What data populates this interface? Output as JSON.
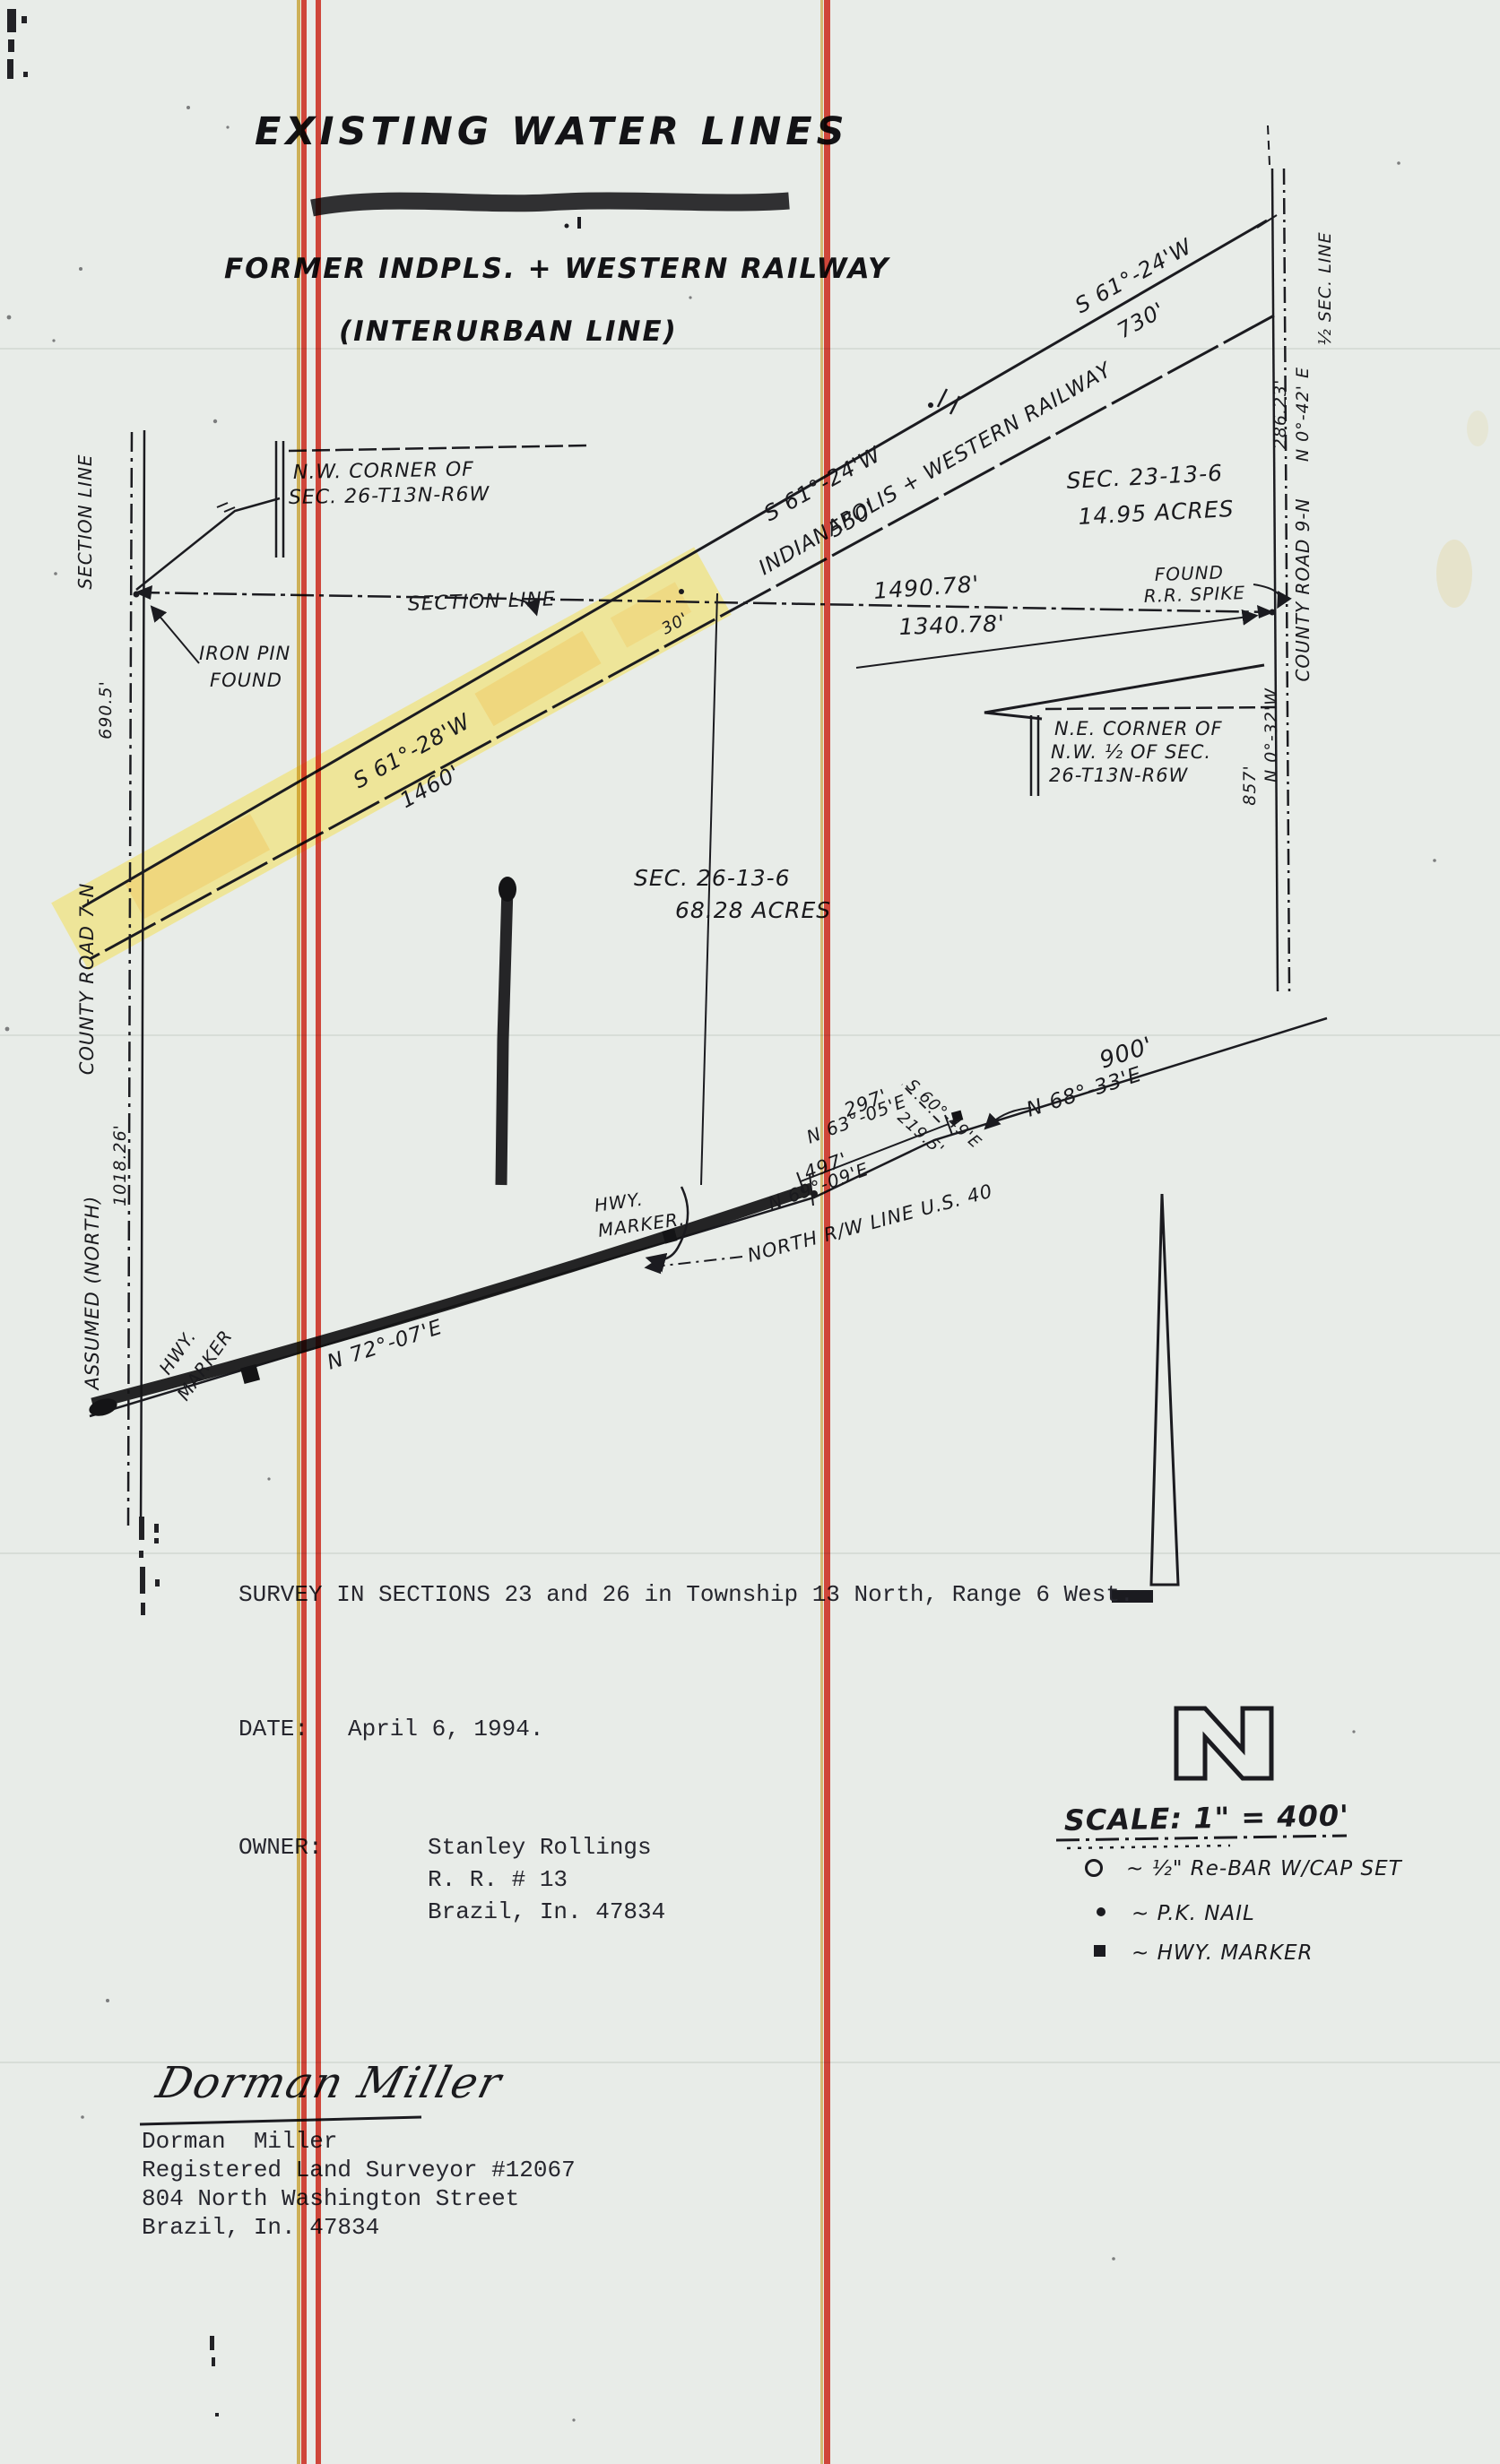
{
  "document": {
    "title": "EXISTING WATER LINES",
    "subtitle_line1": "FORMER INDPLS. + WESTERN RAILWAY",
    "subtitle_line2": "(INTERURBAN LINE)"
  },
  "map": {
    "nw_corner": {
      "l1": "N.W. CORNER OF",
      "l2": "SEC. 26-T13N-R6W"
    },
    "iron_pin": {
      "l1": "IRON PIN",
      "l2": "FOUND"
    },
    "section_line_label": "SECTION LINE",
    "dim_1490": "1490.78'",
    "dim_1340": "1340.78'",
    "dim_30": "30'",
    "found_spike": {
      "l1": "FOUND",
      "l2": "R.R. SPIKE"
    },
    "ne_corner": {
      "l1": "N.E. CORNER OF",
      "l2": "N.W. ½ OF SEC.",
      "l3": "26-T13N-R6W"
    },
    "bearing_730": {
      "bearing": "S 61°-24'W",
      "dist": "730'"
    },
    "bearing_550": {
      "bearing": "S 61°-24'W",
      "dist": "550'"
    },
    "bearing_1460": {
      "bearing": "S 61°-28'W",
      "dist": "1460'"
    },
    "railway_name": "INDIANAPOLIS + WESTERN RAILWAY",
    "sec23": {
      "l1": "SEC. 23-13-6",
      "l2": "14.95 ACRES"
    },
    "sec26": {
      "l1": "SEC. 26-13-6",
      "l2": "68.28 ACRES"
    },
    "right_road": {
      "half_sec": "½ SEC. LINE",
      "bearing": "N 0°-42' E",
      "dim": "286.23'",
      "name": "COUNTY ROAD 9-N",
      "bearing2": "N 0°-32'W",
      "dim2": "857'"
    },
    "left_road": {
      "section": "SECTION LINE",
      "dim": "690.5'",
      "name": "COUNTY ROAD 7-N",
      "dim2": "1018.26'",
      "assumed": "ASSUMED (NORTH)"
    },
    "us40": {
      "bearing_7207": "N 72°-07'E",
      "hwy_marker_a": {
        "l1": "HWY.",
        "l2": "MARKER"
      },
      "hwy_marker_b": {
        "l1": "HWY.",
        "l2": "MARKER."
      },
      "dim_297": "297'",
      "bearing_6305": "N 63°-05'E",
      "bearing_6049": "S 60°-49'E",
      "dim_2195": "219.5'",
      "dim_497": "497'",
      "bearing_6909": "N 69°-09'E",
      "bearing_6833": "N 68°-33'E",
      "dim_900": "900'",
      "rw_label": "NORTH R/W LINE U.S. 40"
    }
  },
  "notes": {
    "survey_line": "SURVEY IN SECTIONS 23 and 26 in Township 13 North, Range 6 West.",
    "date_label": "DATE:",
    "date_value": "April 6, 1994.",
    "owner_label": "OWNER:",
    "owner_name": "Stanley Rollings",
    "owner_addr1": "R. R. # 13",
    "owner_addr2": "Brazil, In. 47834"
  },
  "surveyor": {
    "signature": "Dorman Miller",
    "typed_name": "Dorman  Miller",
    "credential": "Registered Land Surveyor #12067",
    "street": "804 North Washington Street",
    "city": "Brazil, In. 47834"
  },
  "north_arrow": {
    "letter": "N"
  },
  "scale_legend": {
    "scale_text": "SCALE: 1\" = 400'",
    "items": [
      {
        "symbol": "rebar-circle",
        "label": "~ ½\" Re-BAR W/CAP SET"
      },
      {
        "symbol": "pk-nail-dot",
        "label": "~ P.K. NAIL"
      },
      {
        "symbol": "hwy-marker-square",
        "label": "~ HWY. MARKER"
      }
    ]
  },
  "colors": {
    "paper": "#e8ece8",
    "ink": "#1b1b20",
    "highlighter": "#f2e269",
    "stripe_red": "#df2b1d",
    "stripe_yellow": "#d9a82c"
  }
}
